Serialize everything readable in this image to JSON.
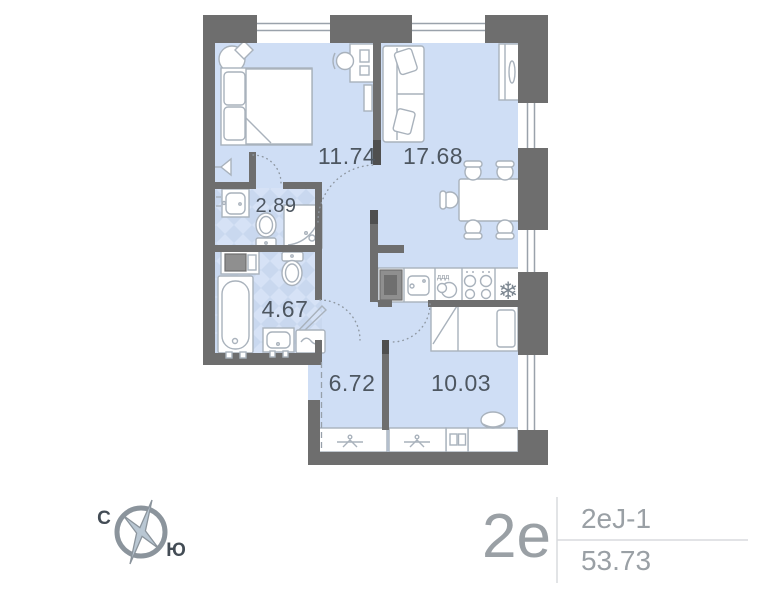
{
  "plan": {
    "rooms": [
      {
        "name": "bedroom",
        "area": "11.74"
      },
      {
        "name": "living-kitchen",
        "area": "17.68"
      },
      {
        "name": "shower-room",
        "area": "2.89"
      },
      {
        "name": "bathroom",
        "area": "4.67"
      },
      {
        "name": "hallway",
        "area": "6.72"
      },
      {
        "name": "bedroom-2",
        "area": "10.03"
      }
    ],
    "icons": {
      "fridge_snowflake": "❄",
      "dish_marks": "ддд"
    }
  },
  "compass": {
    "north": "С",
    "south": "Ю"
  },
  "unit_card": {
    "type": "2е",
    "layout_code": "2еJ-1",
    "total_area": "53.73"
  },
  "colors": {
    "floor": "#cfdef5",
    "tile": "#c9d8ef",
    "tile_light": "#d6e2f6",
    "wall": "#6e6e6e",
    "label": "#4d5660",
    "muted_text": "#9aa0a5",
    "divider": "#d8dadd"
  }
}
